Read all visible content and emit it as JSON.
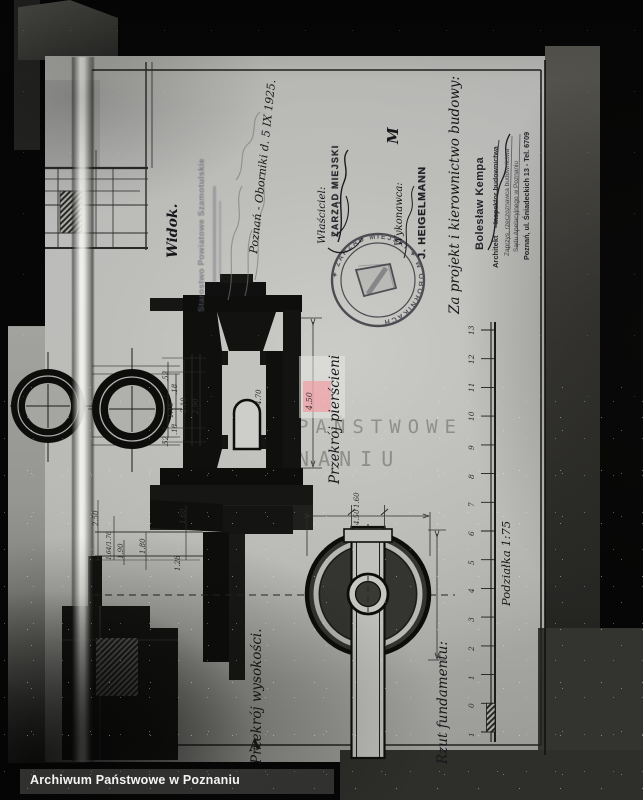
{
  "footer": {
    "caption": "Archiwum Państwowe w Poznaniu"
  },
  "watermark": {
    "line1": "PAŃSTWOWE",
    "line2": "ZNANIU"
  },
  "notes": {
    "view_label": "Widok.",
    "date_note": "Poznań - Oborniki d. 5 IX 1925.",
    "owner_label": "Właściciel:",
    "owner_stamp": "ZARZĄD MIEJSKI",
    "contractor_label": "Wykonawca:",
    "contractor_stamp": "J. HEIGELMANN",
    "credit": "Za projekt i kierownictwo budowy:",
    "mark_m": "M",
    "mark_a": "A"
  },
  "stamps": {
    "starostwo_line1": "Starostwo Powiatowe Szamotulskie",
    "round_text": "✦ ZARZĄD MIEJSKI ✦ W OBORNIKACH",
    "architect_name": "Bolesław Kempa",
    "architect_title1": "Architekt",
    "architect_title2": "Inspektor budownictwa",
    "architect_title3": "Zaprzys. rzeczoznawca budownictwa",
    "architect_title4": "Sądu Apelacyjnego w Poznaniu",
    "architect_address": "Poznań, ul. Śniadeckich 13 - Tel. 6709"
  },
  "labels": {
    "rings_section": "Przekrój pierścieni",
    "heights_section": "Przekrój wysokości.",
    "foundation_plan": "Rzut fundamentu:",
    "scale": "Podziałka 1:75"
  },
  "ruler": {
    "ticks": [
      "13",
      "12",
      "11",
      "10",
      "9",
      "8",
      "7",
      "6",
      "5",
      "4",
      "3",
      "2",
      "1",
      "0",
      "1"
    ]
  },
  "dims": {
    "s1": ".52",
    "s2": ".18",
    "s3": "1.46",
    "s4": "2.10",
    "s5": "2.90",
    "s6": ".18",
    "s7": ".52",
    "niche": "4.70",
    "height_total": "4.50",
    "f1": "2.50",
    "f2": "1.64/1.76",
    "f3": "1.90",
    "f4": "1.80",
    "f5": "1.60",
    "f6": "1.28",
    "plan_inner": "1.60",
    "plan_outer": "4.50"
  },
  "colors": {
    "highlight": "#f2949c",
    "paper": "#bdbdb9",
    "ink": "#15151a"
  }
}
